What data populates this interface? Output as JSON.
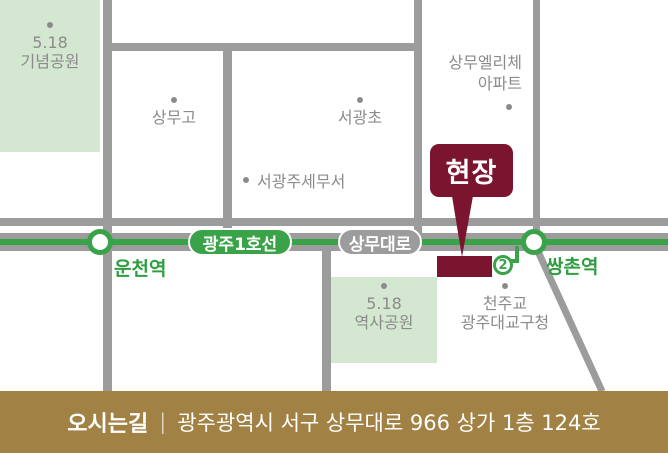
{
  "colors": {
    "road": "#9c9c9c",
    "line_green": "#3aa34a",
    "park_green": "#d4e7d0",
    "maroon": "#7b142f",
    "gold": "#a28244",
    "label_gray": "#8b8b8b",
    "text_green": "#2f9e41"
  },
  "map": {
    "memorial_park": {
      "line1": "5.18",
      "line2": "기념공원"
    },
    "history_park": {
      "line1": "5.18",
      "line2": "역사공원"
    },
    "sangmu_high": {
      "label": "상무고"
    },
    "seogwang_elem": {
      "label": "서광초"
    },
    "tax_office": {
      "label": "서광주세무서"
    },
    "apartment": {
      "line1": "상무엘리체",
      "line2": "아파트"
    },
    "catholic": {
      "line1": "천주교",
      "line2": "광주대교구청"
    },
    "site_badge": {
      "label": "현장"
    },
    "subway": {
      "line_badge": "광주1호선",
      "road_badge": "상무대로",
      "station_left": "운천역",
      "station_right": "쌍촌역",
      "exit_number": "2"
    }
  },
  "footer": {
    "title": "오시는길",
    "divider": "|",
    "address": "광주광역시 서구 상무대로 966 상가 1층 124호"
  }
}
